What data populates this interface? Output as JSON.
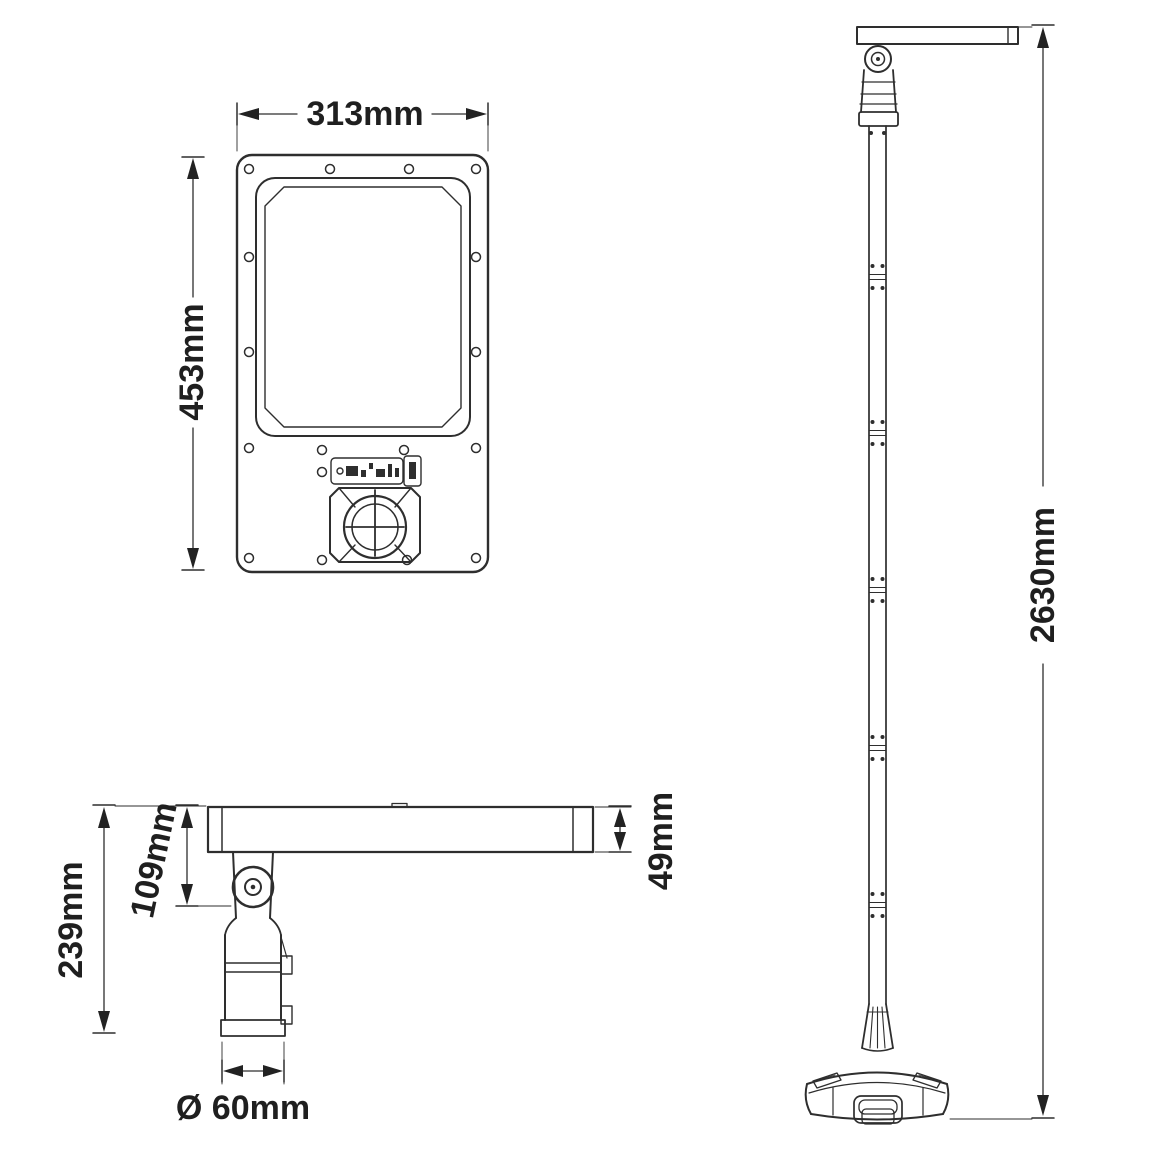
{
  "colors": {
    "line": "#2e2e2e",
    "text": "#1f1f1f",
    "background": "#ffffff"
  },
  "front_view": {
    "width": "313mm",
    "height": "453mm"
  },
  "side_view": {
    "overall_height": "239mm",
    "head_to_pivot": "109mm",
    "head_thickness": "49mm",
    "mount_diameter": "Ø 60mm"
  },
  "pole_view": {
    "overall_height": "2630mm"
  }
}
